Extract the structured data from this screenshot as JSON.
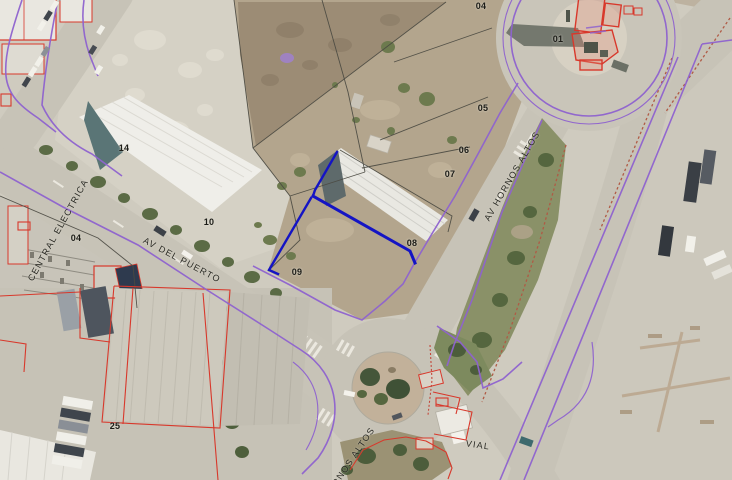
{
  "map": {
    "description": "aerial-cadastral-map",
    "colors": {
      "selection_blue": "#1414c4",
      "boundary_purple": "#8f63cf",
      "cadastral_red": "#d8382b",
      "divider_brown_red": "#b05a45",
      "parcel_line_black": "#4b4a42"
    },
    "parcel_labels": [
      {
        "text": "04",
        "x": 481,
        "y": 6
      },
      {
        "text": "05",
        "x": 483,
        "y": 108
      },
      {
        "text": "06",
        "x": 464,
        "y": 150
      },
      {
        "text": "07",
        "x": 450,
        "y": 174
      },
      {
        "text": "08",
        "x": 412,
        "y": 243
      },
      {
        "text": "09",
        "x": 297,
        "y": 272
      },
      {
        "text": "10",
        "x": 209,
        "y": 222
      },
      {
        "text": "14",
        "x": 124,
        "y": 148
      },
      {
        "text": "04",
        "x": 76,
        "y": 238
      },
      {
        "text": "25",
        "x": 115,
        "y": 426
      },
      {
        "text": "01",
        "x": 558,
        "y": 39
      }
    ],
    "street_labels": [
      {
        "text": "CENTRAL ELECTRICA",
        "x": 58,
        "y": 230,
        "rot": -61
      },
      {
        "text": "AV DEL PUERTO",
        "x": 182,
        "y": 260,
        "rot": 28
      },
      {
        "text": "AV HORNOS ALTOS",
        "x": 512,
        "y": 176,
        "rot": -60
      },
      {
        "text": "HORNOS ALTOS",
        "x": 349,
        "y": 463,
        "rot": -56
      },
      {
        "text": "VIAL",
        "x": 478,
        "y": 445,
        "rot": 8
      }
    ]
  }
}
